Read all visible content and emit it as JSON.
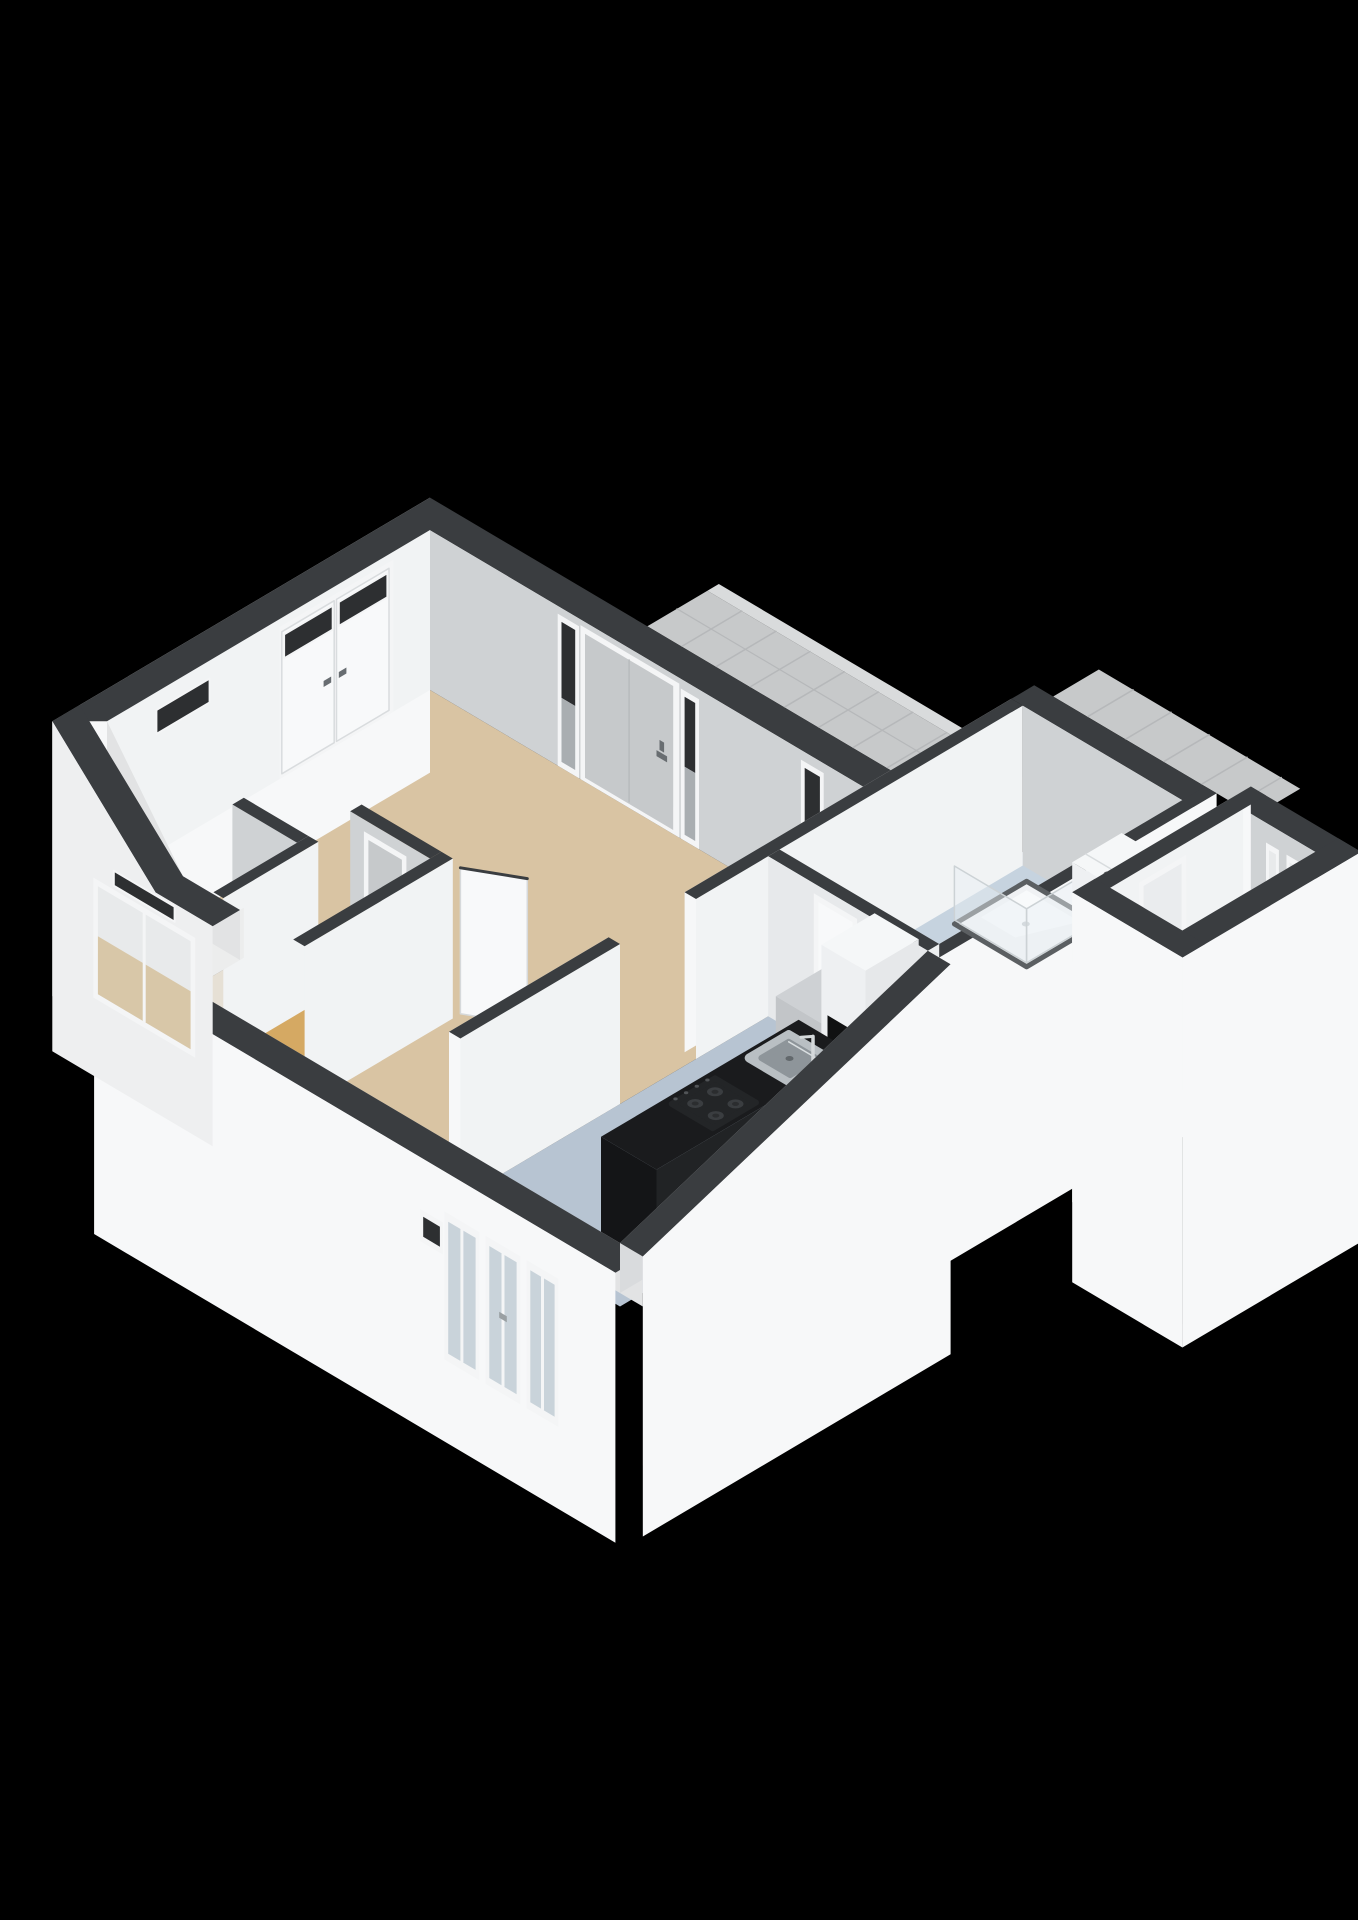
{
  "canvas": {
    "width": 1358,
    "height": 1920
  },
  "scene": {
    "kind": "isometric-3d-floorplan-render",
    "background": "#000000"
  },
  "rooms": [
    {
      "id": "living-room",
      "floor": "floor_living"
    },
    {
      "id": "hallway",
      "floor": "floor_living"
    },
    {
      "id": "closet-small",
      "floor": "floor_closet_small"
    },
    {
      "id": "closet",
      "floor": "floor_closet"
    },
    {
      "id": "kitchen",
      "floor": "floor_kitchen"
    },
    {
      "id": "bathroom",
      "floor": "floor_bathroom"
    },
    {
      "id": "storage-room",
      "floor": "floor_storage"
    },
    {
      "id": "gallery-walkway",
      "floor": "gallery_tile"
    }
  ],
  "fixtures": [
    "entrance-door",
    "entrance-sidelight",
    "hall-window",
    "balcony-doors",
    "transom-windows",
    "picture-window",
    "kitchen-windows",
    "kitchen-counter",
    "kitchen-sink",
    "sink-faucet",
    "gas-hob",
    "refrigerator",
    "base-cabinet",
    "shower",
    "shower-glass",
    "washing-machine",
    "closet-door",
    "bathroom-door",
    "storage-door",
    "storage-windows",
    "open-door-leaf",
    "vent-grille",
    "window-handle"
  ],
  "palette": {
    "background": "#000000",
    "wall_top": "#3a3d40",
    "wall_inner_lit": "#f1f3f4",
    "wall_inner_shade": "#cfd2d4",
    "wall_outer": "#f7f8f9",
    "wall_outer_dim": "#eeeff0",
    "wall_base_shadow": "#e2e3e4",
    "wall_sliver": "#d9dbdd",
    "floor_living": "#d9c4a3",
    "floor_closet_small": "#e6e0d5",
    "floor_closet": "#d5a963",
    "floor_kitchen": "#b7c4d2",
    "floor_bathroom": "#c6d3df",
    "floor_storage": "#e7e9ea",
    "gallery_tile": "#c7c9ca",
    "gallery_tile_line": "#b6b8ba",
    "gallery_edge": "#d9dbdc",
    "counter_top": "#1a1b1d",
    "counter_front": "#141517",
    "counter_side": "#212325",
    "sink_steel": "#b9bfc3",
    "sink_bowl": "#8e959a",
    "sink_rim": "#d9dee0",
    "hob_body": "#232527",
    "hob_burner": "#3a3d40",
    "hob_burner_core": "#2b2d2f",
    "door_gray": "#c6c9cb",
    "door_white": "#f8f9fa",
    "frame_white": "#f4f5f6",
    "handle_dark": "#686d71",
    "glass_dark": "#2d2f31",
    "glass_light": "#c9d3da",
    "glass_gray": "#a9aeb1",
    "glass_warm": "#d8c7a8",
    "glass_pale": "#e8eaeb",
    "shower_tray": "#f0f2f4",
    "shower_rim": "#5b5f62",
    "shower_sheen": "#fbfdfe",
    "glass_panel": "rgba(232,240,245,0.45)",
    "glass_panel_edge": "#ccd2d5",
    "appliance_top": "#f5f7f8",
    "appliance_front": "#eef0f2",
    "appliance_side": "#e3e6e8",
    "fridge_stripe": "#101112",
    "knob_dark": "#3a3d3f",
    "knob_core": "#707477",
    "cabinet_top": "#ced1d4",
    "cabinet_front": "#c2c5c8",
    "cabinet_side": "#b4b7ba"
  }
}
